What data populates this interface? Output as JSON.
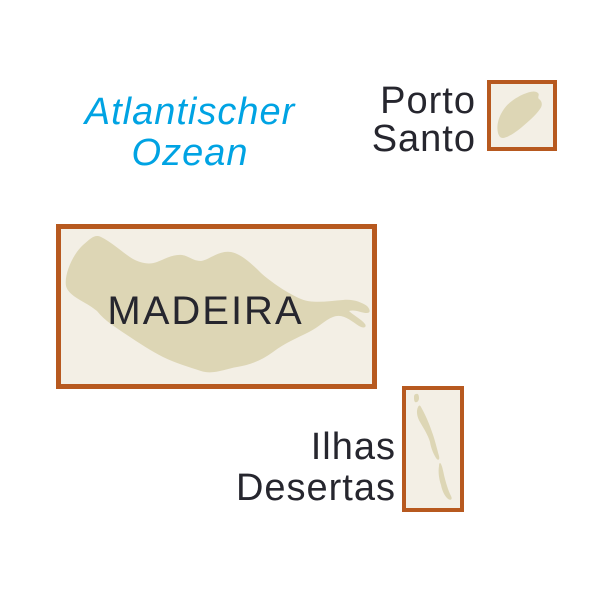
{
  "map_title": "Madeira archipelago overview map",
  "colors": {
    "background": "#ffffff",
    "frame": "#b7591f",
    "box_fill": "#f3efe5",
    "island_fill": "#ddd6b5",
    "label_dark": "#26262e",
    "ocean_blue": "#00a3e3"
  },
  "ocean": {
    "lines": [
      "Atlantischer",
      "Ozean"
    ]
  },
  "porto_santo": {
    "label_lines": [
      "Porto",
      "Santo"
    ]
  },
  "madeira": {
    "label": "MADEIRA"
  },
  "ilhas_desertas": {
    "label_lines": [
      "Ilhas",
      "Desertas"
    ]
  }
}
